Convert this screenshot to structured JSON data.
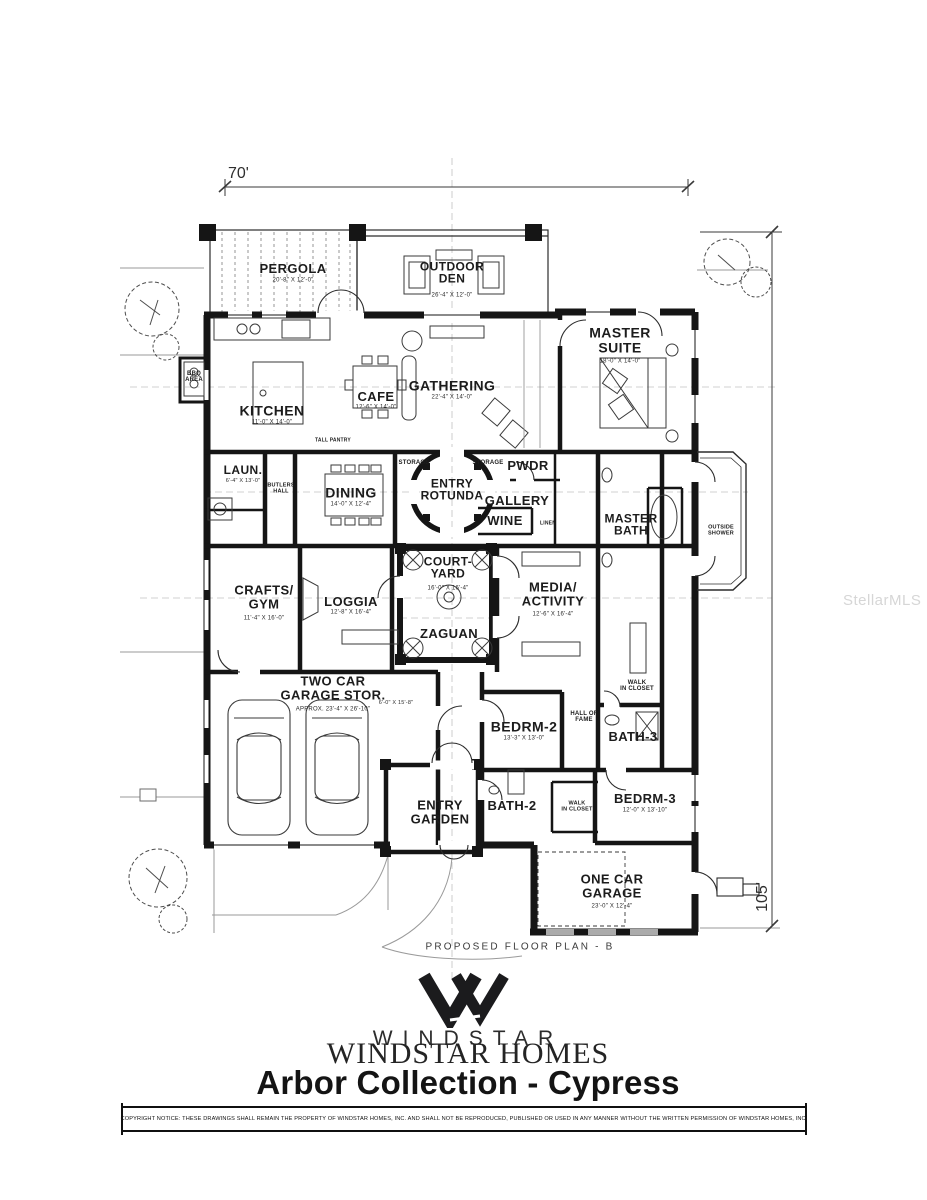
{
  "watermark": "StellarMLS",
  "dimensions": {
    "width_label": "70'",
    "height_label": "105'"
  },
  "plan_caption": "PROPOSED FLOOR PLAN - B",
  "brand": {
    "logo_icon": "windstar-w-mark",
    "wordmark_spaced": "WINDSTAR",
    "wordmark_serif": "WINDSTAR HOMES",
    "plan_title": "Arbor Collection - Cypress"
  },
  "copyright": "COPYRIGHT NOTICE:   THESE DRAWINGS SHALL REMAIN THE PROPERTY OF WINDSTAR HOMES, INC. AND SHALL NOT BE REPRODUCED, PUBLISHED OR USED IN ANY MANNER WITHOUT THE WRITTEN PERMISSION OF WINDSTAR HOMES, INC.",
  "colors": {
    "wall": "#151515",
    "guide": "#bdbdbd",
    "site": "#9a9a9a",
    "watermark": "#cfcfcf"
  },
  "rooms": {
    "pergola": {
      "name": "PERGOLA",
      "dims": "20'-8\" X 12'-0\""
    },
    "outdoor_den": {
      "name": "OUTDOOR\nDEN",
      "dims": "26'-4\" X 12'-0\""
    },
    "master_suite": {
      "name": "MASTER\nSUITE",
      "dims": "18'-0\" X 14'-0\""
    },
    "kitchen": {
      "name": "KITCHEN",
      "dims": "11'-0\" X 14'-0\""
    },
    "cafe": {
      "name": "CAFE",
      "dims": "12'-6\" X 14'-0\""
    },
    "gathering": {
      "name": "GATHERING",
      "dims": "22'-4\" X 14'-0\""
    },
    "bbq": {
      "name": "BBQ\nAREA"
    },
    "laun": {
      "name": "LAUN.",
      "dims": "6'-4\" X 13'-0\""
    },
    "butlers_hall": {
      "name": "BUTLERS\nHALL"
    },
    "dining": {
      "name": "DINING",
      "dims": "14'-0\" X 12'-4\""
    },
    "storage_l": {
      "name": "STORAGE"
    },
    "storage_r": {
      "name": "STORAGE"
    },
    "entry_rotunda": {
      "name": "ENTRY\nROTUNDA"
    },
    "gallery": {
      "name": "GALLERY"
    },
    "pwdr": {
      "name": "PWDR"
    },
    "wine": {
      "name": "WINE"
    },
    "master_bath": {
      "name": "MASTER\nBATH"
    },
    "outside_shower": {
      "name": "OUTSIDE\nSHOWER"
    },
    "crafts_gym": {
      "name": "CRAFTS/\nGYM",
      "dims": "11'-4\" X 16'-0\""
    },
    "loggia": {
      "name": "LOGGIA",
      "dims": "12'-8\" X 16'-4\""
    },
    "courtyard": {
      "name": "COURT-\nYARD",
      "dims": "16'-0\" X 16'-4\""
    },
    "zaguan": {
      "name": "ZAGUAN"
    },
    "media_activity": {
      "name": "MEDIA/\nACTIVITY",
      "dims": "12'-6\" X 16'-4\""
    },
    "wic_master": {
      "name": "WALK\nIN CLOSET"
    },
    "garage2": {
      "name": "TWO CAR\nGARAGE STOR.",
      "dims": "APPROX. 23'-4\" X 26'-10\"",
      "dims2": "6'-0\" X 15'-8\""
    },
    "bedrm2": {
      "name": "BEDRM-2",
      "dims": "13'-3\" X 13'-0\""
    },
    "hall_of_fame": {
      "name": "HALL OF\nFAME"
    },
    "bath3": {
      "name": "BATH-3"
    },
    "entry_garden": {
      "name": "ENTRY\nGARDEN"
    },
    "bath2": {
      "name": "BATH-2"
    },
    "wic2": {
      "name": "WALK\nIN CLOSET"
    },
    "bedrm3": {
      "name": "BEDRM-3",
      "dims": "12'-0\" X 13'-10\""
    },
    "garage1": {
      "name": "ONE CAR\nGARAGE",
      "dims": "23'-0\" X 12'-4\""
    },
    "tall_pantry": {
      "name": "TALL PANTRY"
    },
    "linen": {
      "name": "LINEN"
    }
  }
}
